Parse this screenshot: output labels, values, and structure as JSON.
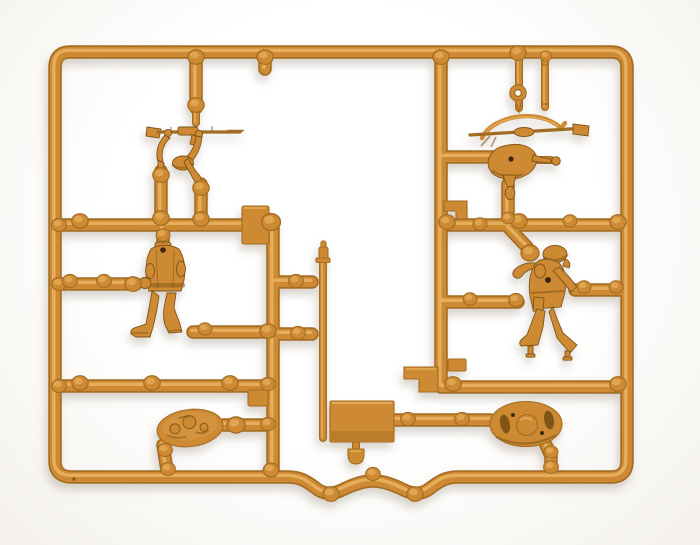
{
  "scene": {
    "type": "photograph",
    "subject": "Plastic model-kit sprue with miniature soldier figures",
    "description": "Top-down photograph of a tan injection-moulded plastic sprue (runner frame) holding four miniature soldier figure parts, two oval display bases, a rectangular moulding plate, a thin pole and several small accessory pins, shot on a plain white background.",
    "material": "tan/ochre polystyrene plastic",
    "object_counts": {
      "soldier_figures": 4,
      "oval_bases": 2,
      "rectangular_plates": 1
    },
    "parts": [
      "rifleman arms holding rifle with helmet",
      "machine-gunner body with bipod MG and sling arc",
      "standing soldier body (separate head socket)",
      "grenadier figure with helmet and foot pegs",
      "textured oval display base",
      "oval base underside with slots",
      "rectangular moulding plate",
      "thin pole",
      "eyelet pin",
      "rod pin",
      "dome knob",
      "step tabs and connector nubs"
    ]
  },
  "colors": {
    "background": "#f4f1eb",
    "plastic_mid": "#cd8a31",
    "plastic_highlight": "#eab463",
    "plastic_edge": "#a26c22",
    "plastic_deep": "#7e5418",
    "hole": "#3d2710",
    "shadow": "#9a8c77"
  }
}
